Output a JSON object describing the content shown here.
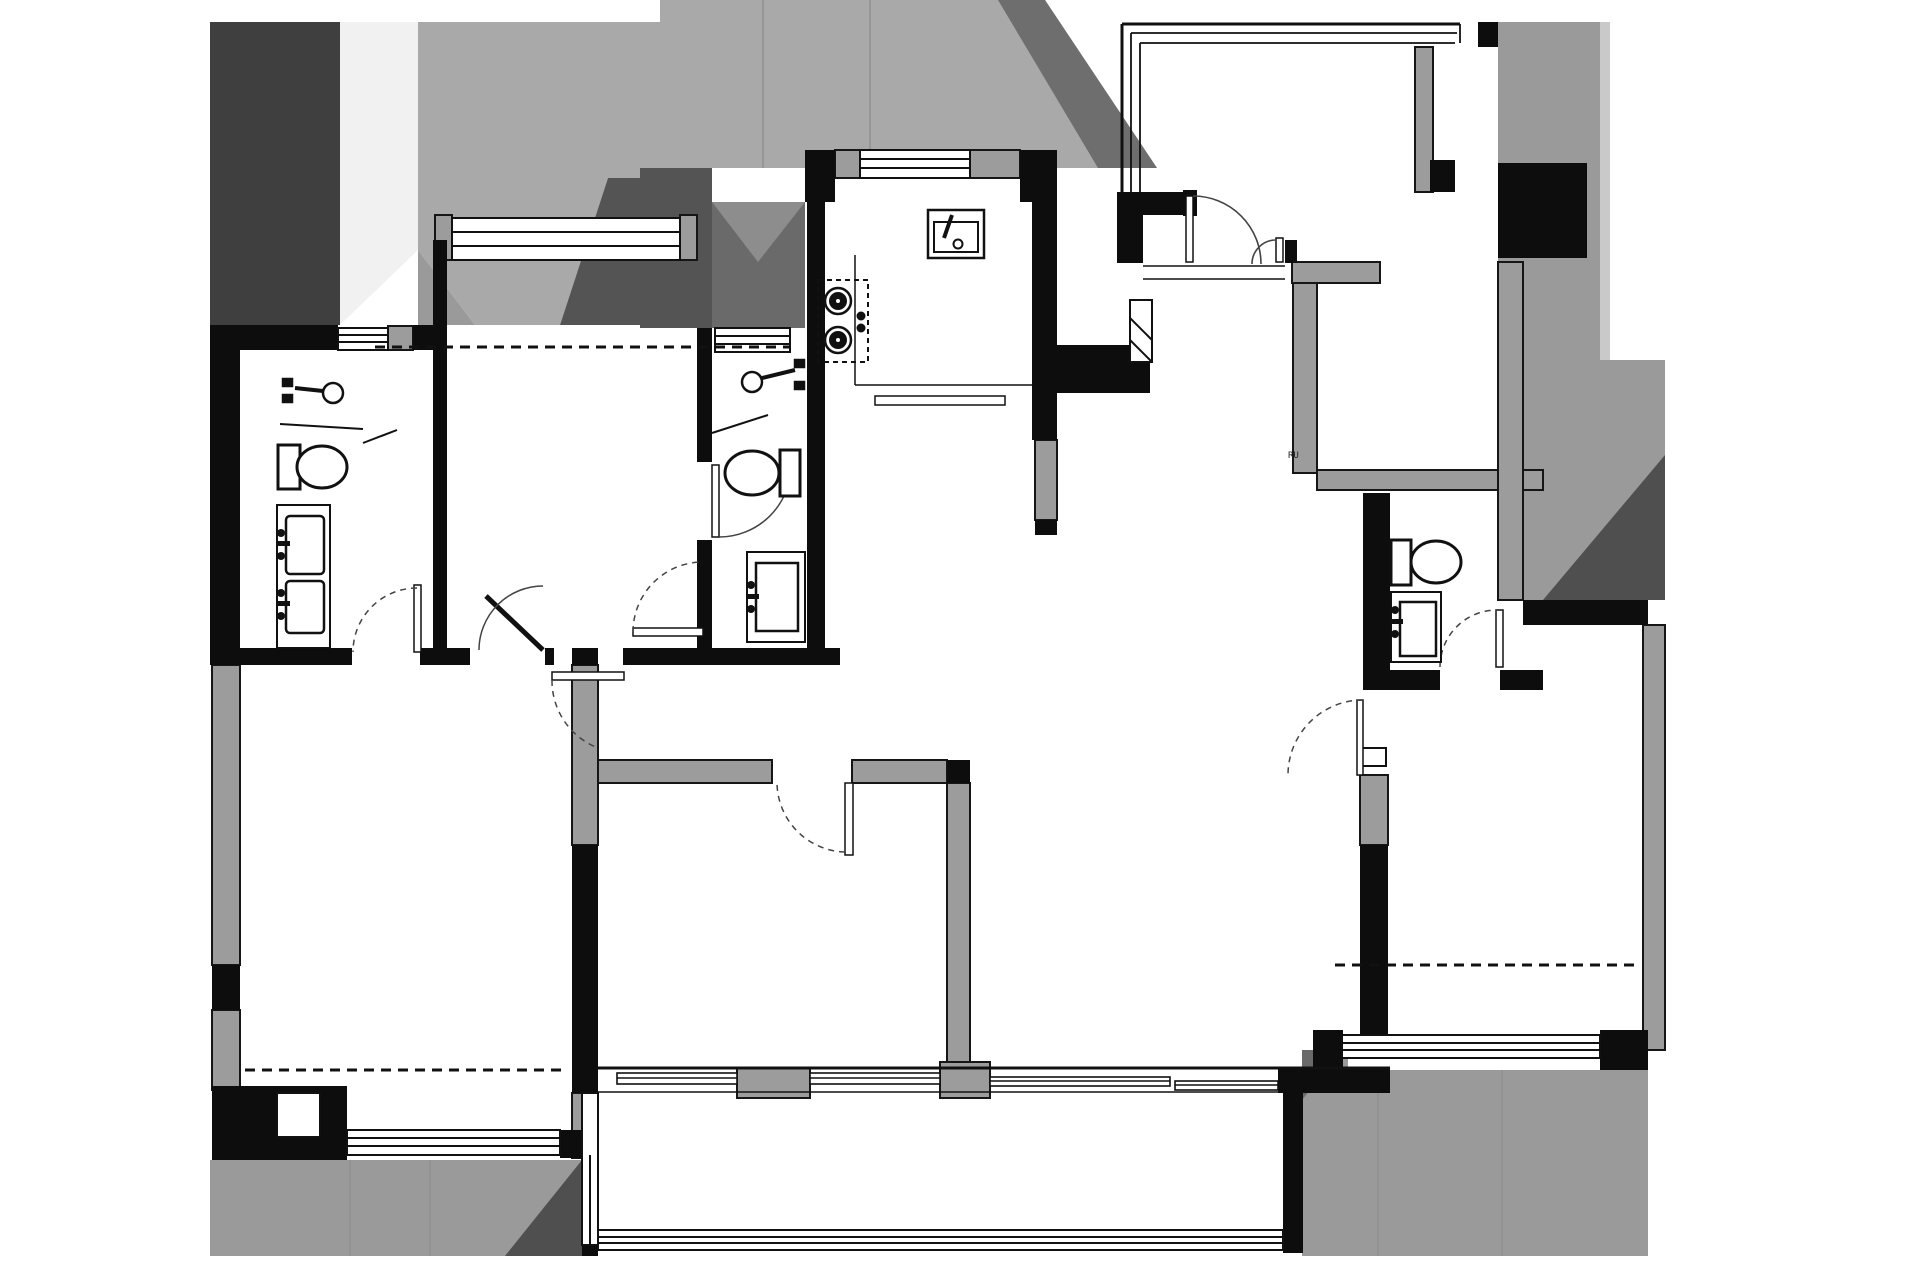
{
  "meta": {
    "drawing_kind": "Apartment floor plan, black and white CAD line drawing with gray context shading",
    "visible_text_label": "RU"
  },
  "palette": {
    "bg": "#ffffff",
    "wall": "#0d0d0d",
    "wall_gray": "#9c9c9c",
    "context_darkest": "#3f3f3f",
    "context_dark": "#545454",
    "context_mid": "#9a9a9a",
    "context_soft": "#a9a9a9",
    "context_light": "#c9c9c9",
    "context_lighter": "#f1f1f1",
    "lightwell": "#6a6a6a",
    "line": "#1a1a1a",
    "arc": "#444444"
  },
  "label": {
    "text": "RU"
  },
  "inventory": {
    "rooms": [
      "bedroom-top-left",
      "bathroom-left",
      "bedroom-bottom-left",
      "hallway",
      "bathroom-middle",
      "kitchen",
      "entry-foyer",
      "living-dining",
      "room-top-right",
      "room-right-middle",
      "bathroom-right",
      "bedroom-bottom-center",
      "bedroom-bottom-right",
      "balcony"
    ],
    "fixtures": {
      "toilets": 3,
      "vanity_sinks": 4,
      "shower_heads": 2,
      "kitchen_sink": 1,
      "cooktop_burners": 2,
      "appliance_shaft": 1
    },
    "openings": {
      "swing_doors": 10,
      "double_entry_door_leaves": 2,
      "windows": 10,
      "sliding_window_segments": 4
    },
    "dashed_lines": 3
  }
}
